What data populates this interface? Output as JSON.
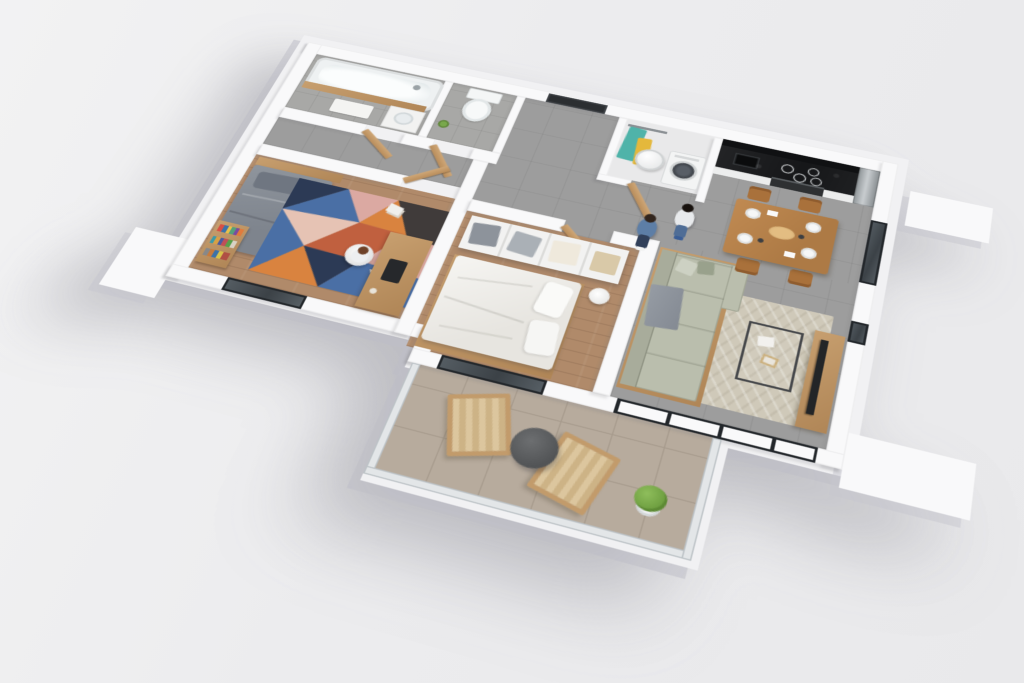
{
  "scene": {
    "type": "3d-floorplan-render",
    "title": "Isometric cutaway 3D floor plan of a two-bedroom apartment with balcony",
    "view": "top-down oblique, rotated ~17deg, seen from above south-west",
    "background_color": "#ececee",
    "no_visible_text": true
  },
  "palette": {
    "slab": "#f1f1f3",
    "wall": "#f9f9fa",
    "floorTile": "#9d9d9d",
    "floorBath": "#a8a8a6",
    "floorWood": "#b08a6a",
    "balcTile": "#b7ab9d",
    "balcGrout": "#a append89c8e",
    "sofa": "#babead",
    "rugBeige": "#cfc9b9",
    "counterBlack": "#1c1d1f",
    "splashBlack": "#101113",
    "oakDoor": "#c49a6c",
    "bedGray": "#868c94",
    "bedWhite": "#f0efec",
    "denimShirt": "#5d7ea6",
    "darkJeans": "#31405a",
    "lightTee": "#e8eaec",
    "midJeans": "#4f6d96",
    "steelAppliance": "#aeb3b6",
    "tvBlack": "#232527",
    "plantGreen": "#79a84c",
    "glassDark": "#3c4247",
    "rugNavy": "#2c3a55",
    "rugBlue": "#4a6fa5",
    "rugOrange": "#d9833f",
    "rugTerracotta": "#c0603f",
    "rugPink": "#dba9a2",
    "rugBlush": "#e6c3b4",
    "rugCharcoal": "#403b3a",
    "rugCream": "#e2d7c8"
  },
  "rooms": [
    {
      "id": "bathroom",
      "name": "Bathroom",
      "furniture": [
        "bathtub with oak front panel and chrome faucet",
        "white bath mat",
        "vanity with washbasin",
        "grey tiled floor"
      ]
    },
    {
      "id": "wc",
      "name": "Toilet room",
      "furniture": [
        "white toilet with cistern",
        "small green plant",
        "grey tiled walls"
      ]
    },
    {
      "id": "hallway",
      "name": "Entrance hall",
      "furniture": [
        "dark entrance door",
        "four open oak interior doors",
        "grey tile floor"
      ]
    },
    {
      "id": "utility-closet",
      "name": "Utility closet",
      "furniture": [
        "clothes rail with teal and yellow garments",
        "white water heater cylinder",
        "front-loading washing machine",
        "oak closet door"
      ]
    },
    {
      "id": "kitchen",
      "name": "Kitchen",
      "furniture": [
        "black marble backsplash",
        "black worktop with sink",
        "induction hob with four rings",
        "built-in oven",
        "white lower cabinets",
        "stainless-steel fridge"
      ]
    },
    {
      "id": "living-dining",
      "name": "Living / dining room",
      "furniture": [
        "wooden dining table set with plates and platter",
        "four wooden chairs",
        "L-shaped sage sofa with grey throw",
        "beige herringbone rug",
        "metal-frame coffee table with magazines",
        "wooden TV bench with flat TV",
        "floor-to-ceiling glazing to balcony",
        "window in right wall"
      ]
    },
    {
      "id": "bedroom-1",
      "name": "Kids bedroom",
      "furniture": [
        "single bed with grey bedding and oak headboard shelf",
        "multicoloured geometric rug",
        "oak desk with laptop",
        "white desk chair",
        "bookshelf with colourful books",
        "window in bottom wall"
      ]
    },
    {
      "id": "bedroom-2",
      "name": "Master bedroom",
      "furniture": [
        "double bed with white duvet and pillows on oak base",
        "white open-top wardrobe with folded clothes",
        "round bedside table",
        "window in bottom wall"
      ]
    },
    {
      "id": "balcony",
      "name": "Balcony",
      "furniture": [
        "two wood-and-canvas lounge chairs",
        "round dark grey coffee table",
        "green potted plant",
        "beige floor tiles",
        "glass railing"
      ]
    }
  ],
  "people": [
    {
      "id": "person-woman",
      "pose": "standing",
      "location": "living room near kitchen",
      "appearance": "dark brown hair, blue denim shirt, dark jeans, white sneakers"
    },
    {
      "id": "person-man",
      "pose": "standing",
      "location": "living room near kitchen",
      "appearance": "dark hair, light grey t-shirt, blue jeans, blue slides"
    },
    {
      "id": "person-child",
      "pose": "seated at desk",
      "location": "kids bedroom",
      "appearance": "auburn hair, white top, seated on white chair"
    }
  ]
}
